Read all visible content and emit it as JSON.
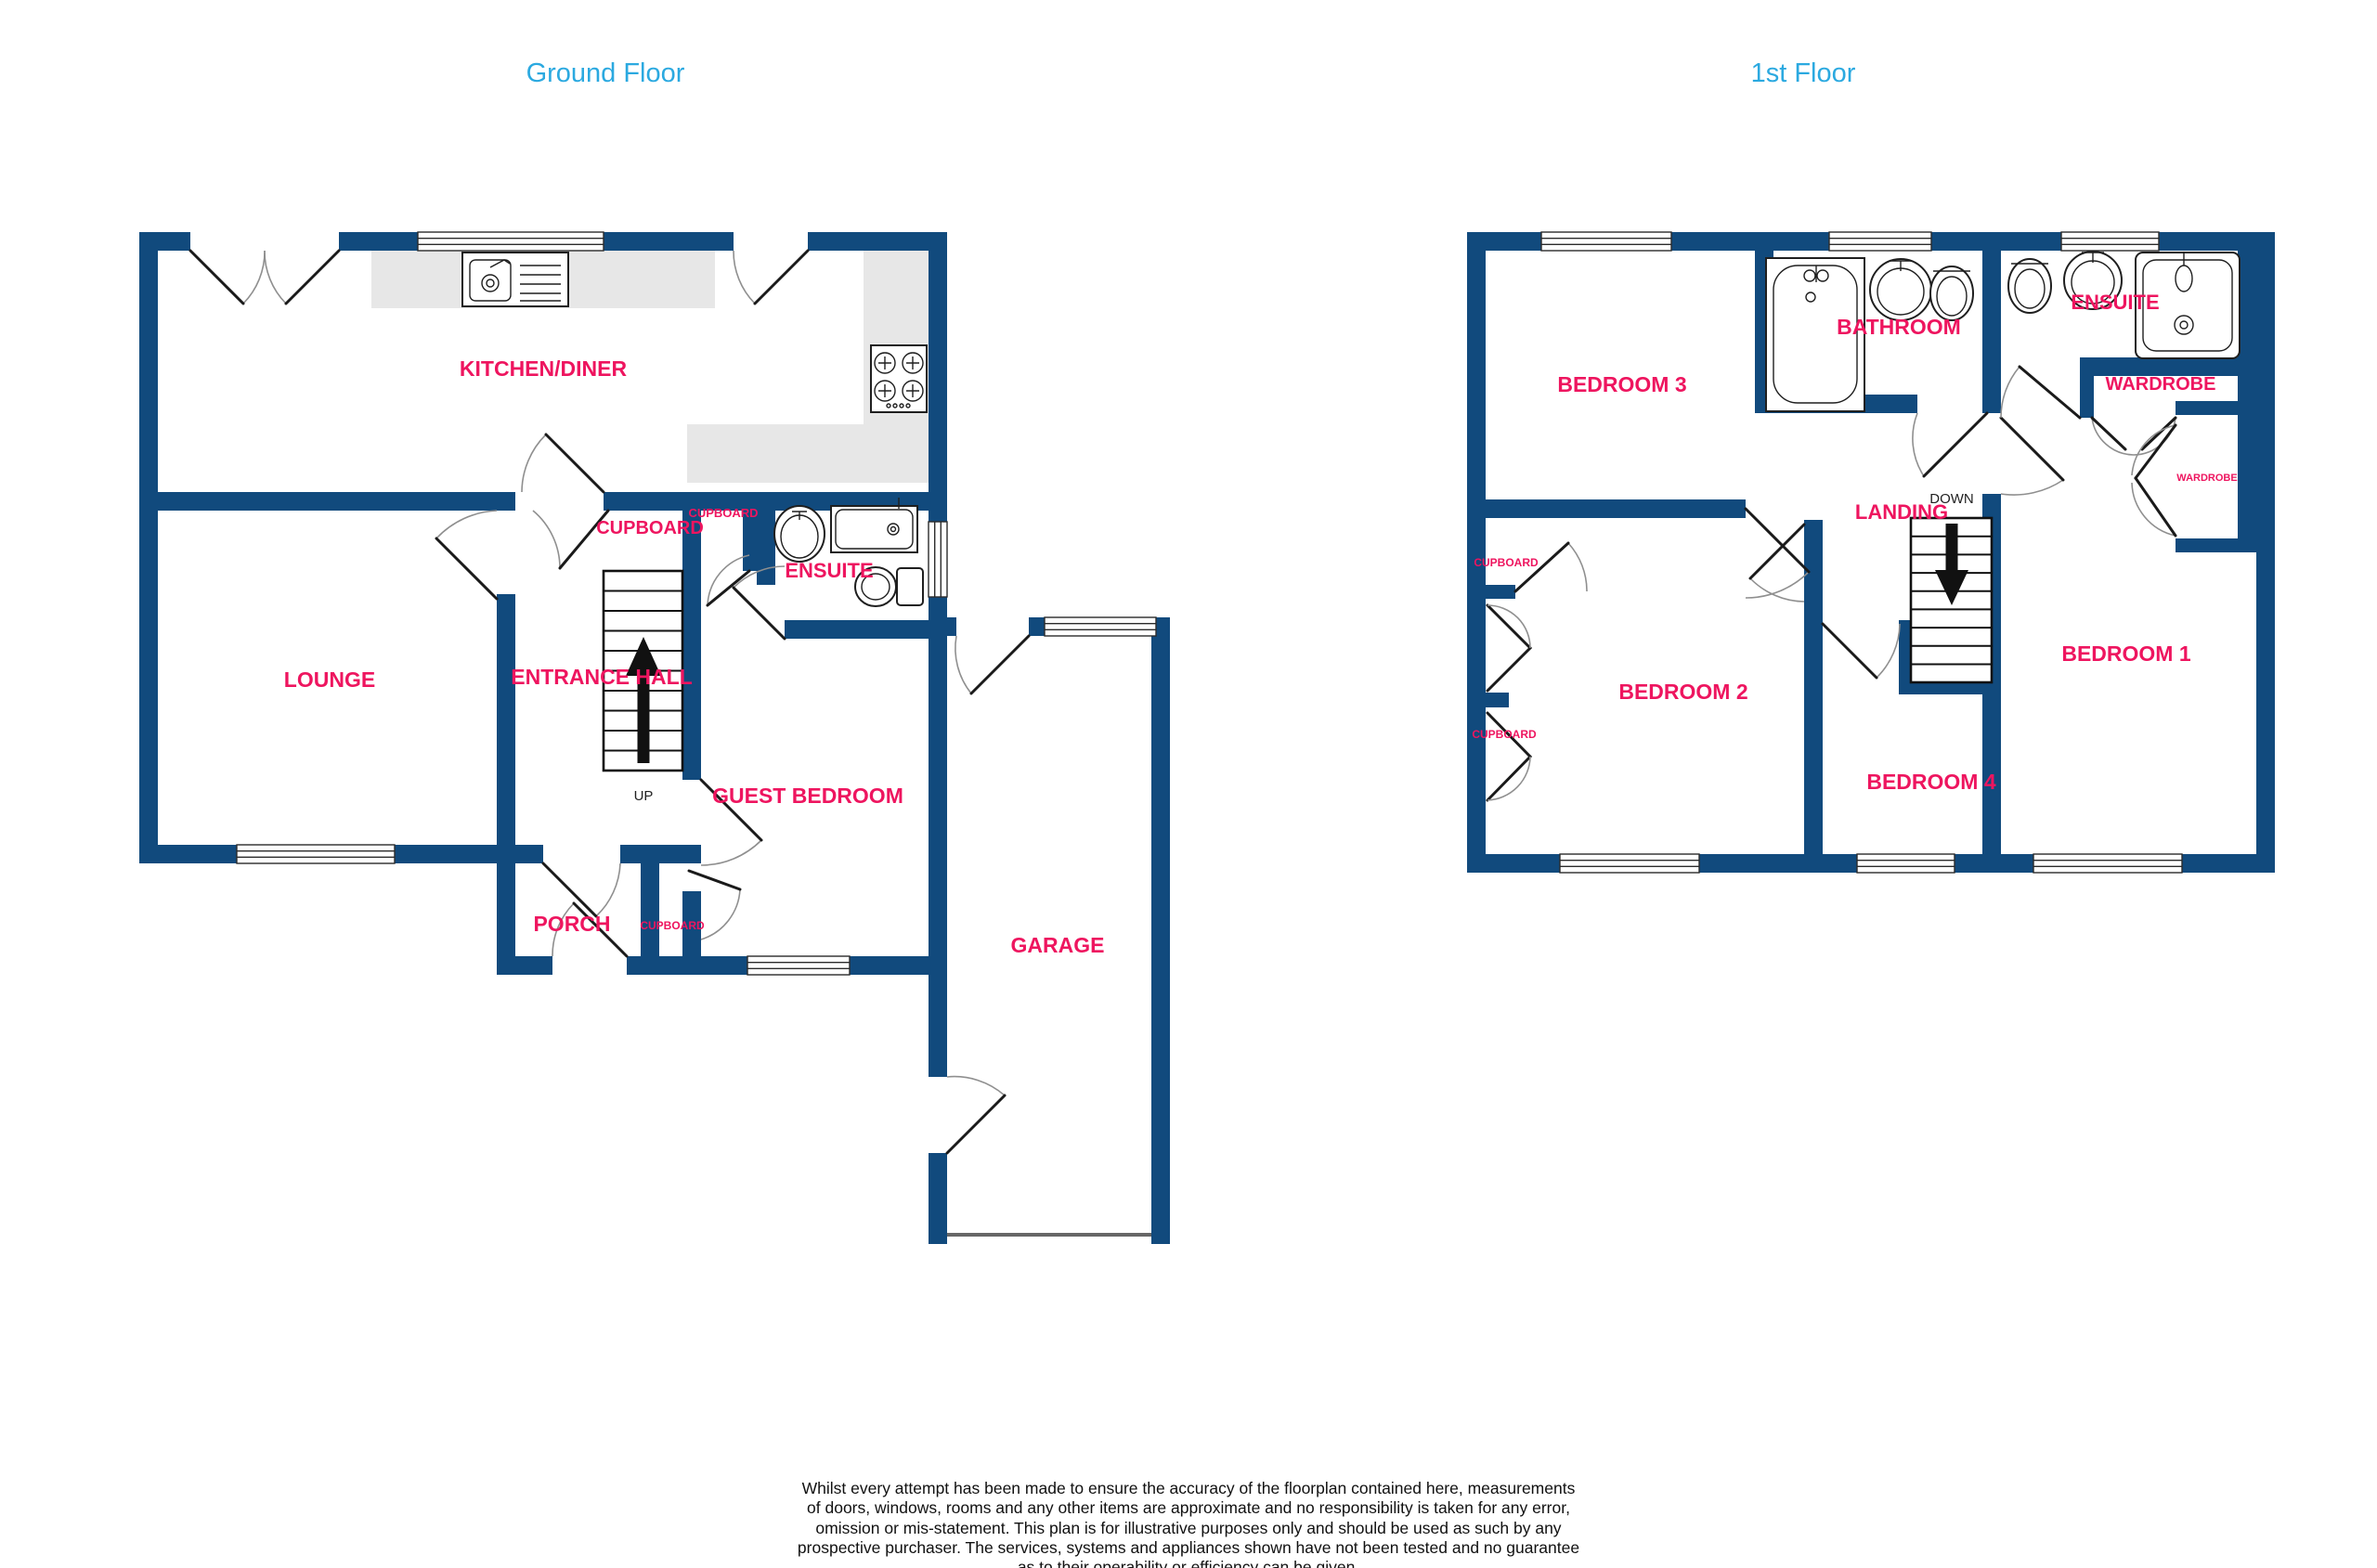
{
  "titles": {
    "ground": "Ground Floor",
    "first": "1st Floor"
  },
  "ground_floor": {
    "labels": {
      "kitchen_diner": "KITCHEN/DINER",
      "lounge": "LOUNGE",
      "entrance_hall": "ENTRANCE HALL",
      "cupboard_main": "CUPBOARD",
      "cupboard_small": "CUPBOARD",
      "ensuite": "ENSUITE",
      "guest_bedroom": "GUEST BEDROOM",
      "up": "UP",
      "porch": "PORCH",
      "cupboard_porch": "CUPBOARD",
      "garage": "GARAGE"
    }
  },
  "first_floor": {
    "labels": {
      "bedroom3": "BEDROOM 3",
      "bathroom": "BATHROOM",
      "ensuite": "ENSUITE",
      "wardrobe": "WARDROBE",
      "wardrobe_small": "WARDROBE",
      "landing": "LANDING",
      "down": "DOWN",
      "bedroom2": "BEDROOM 2",
      "bedroom4": "BEDROOM 4",
      "bedroom1": "BEDROOM 1",
      "cupboard_upper": "CUPBOARD",
      "cupboard_lower": "CUPBOARD"
    }
  },
  "footer": {
    "lines": [
      "Whilst every attempt has been made to ensure the accuracy of the floorplan contained here, measurements",
      "of doors, windows, rooms and any other items are approximate and no responsibility is taken for any error,",
      "omission or mis-statement. This plan is for illustrative purposes only and should be used as such by any",
      "prospective purchaser. The services, systems and appliances shown have not been tested and no guarantee",
      "as to their operability or efficiency can be given.",
      "Made with Metropix ©2026"
    ]
  },
  "colors": {
    "wall": "#114A7D",
    "label": "#EE155F",
    "title": "#2BA9E0",
    "counter": "#E7E7E7"
  }
}
